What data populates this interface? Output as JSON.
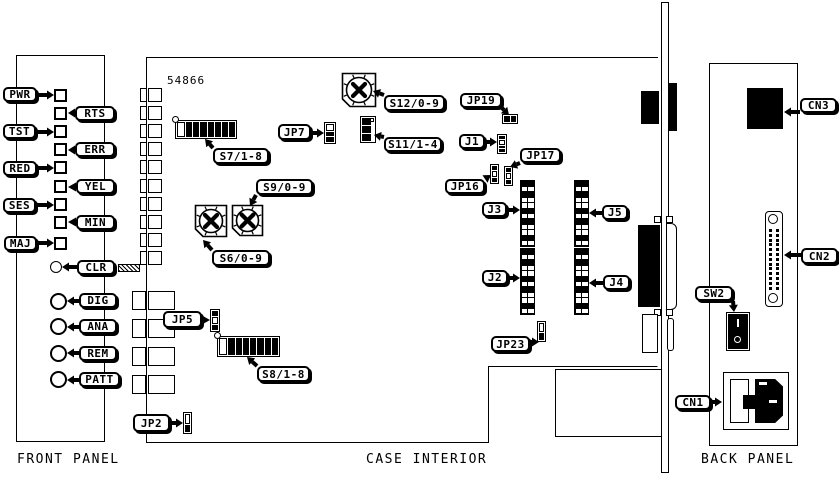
{
  "front_panel": {
    "caption": "FRONT PANEL"
  },
  "case_interior": {
    "caption": "CASE INTERIOR",
    "board_number": "54866"
  },
  "back_panel": {
    "caption": "BACK PANEL",
    "switch_marks": [
      "I",
      "O"
    ]
  },
  "colors": {
    "line": "#000000",
    "background": "#ffffff"
  },
  "callouts": [
    {
      "text": "PWR",
      "x": 3,
      "y": 87,
      "w": 34,
      "h": 15,
      "tx": 54,
      "ty": 95
    },
    {
      "text": "RTS",
      "x": 75,
      "y": 106,
      "w": 40,
      "h": 15,
      "tx": 68,
      "ty": 113
    },
    {
      "text": "TST",
      "x": 3,
      "y": 124,
      "w": 33,
      "h": 15,
      "tx": 54,
      "ty": 132
    },
    {
      "text": "ERR",
      "x": 75,
      "y": 142,
      "w": 40,
      "h": 15,
      "tx": 68,
      "ty": 150
    },
    {
      "text": "RED",
      "x": 3,
      "y": 161,
      "w": 34,
      "h": 15,
      "tx": 54,
      "ty": 168
    },
    {
      "text": "YEL",
      "x": 76,
      "y": 179,
      "w": 39,
      "h": 15,
      "tx": 68,
      "ty": 187
    },
    {
      "text": "SES",
      "x": 3,
      "y": 198,
      "w": 33,
      "h": 15,
      "tx": 54,
      "ty": 205
    },
    {
      "text": "MIN",
      "x": 76,
      "y": 215,
      "w": 39,
      "h": 15,
      "tx": 68,
      "ty": 222
    },
    {
      "text": "MAJ",
      "x": 4,
      "y": 236,
      "w": 33,
      "h": 15,
      "tx": 54,
      "ty": 243
    },
    {
      "text": "CLR",
      "x": 77,
      "y": 260,
      "w": 38,
      "h": 15,
      "tx": 62,
      "ty": 267
    },
    {
      "text": "DIG",
      "x": 79,
      "y": 293,
      "w": 38,
      "h": 15,
      "tx": 67,
      "ty": 301
    },
    {
      "text": "ANA",
      "x": 79,
      "y": 319,
      "w": 38,
      "h": 15,
      "tx": 67,
      "ty": 327
    },
    {
      "text": "REM",
      "x": 79,
      "y": 346,
      "w": 38,
      "h": 15,
      "tx": 67,
      "ty": 353
    },
    {
      "text": "PATT",
      "x": 79,
      "y": 372,
      "w": 41,
      "h": 15,
      "tx": 67,
      "ty": 380
    },
    {
      "text": "S7/1-8",
      "x": 213,
      "y": 148,
      "w": 56,
      "h": 16,
      "tx": 205,
      "ty": 139
    },
    {
      "text": "JP7",
      "x": 278,
      "y": 124,
      "w": 33,
      "h": 16,
      "tx": 324,
      "ty": 133
    },
    {
      "text": "S12/0-9",
      "x": 384,
      "y": 95,
      "w": 61,
      "h": 16,
      "tx": 373,
      "ty": 91
    },
    {
      "text": "JP19",
      "x": 460,
      "y": 93,
      "w": 42,
      "h": 15,
      "tx": 509,
      "ty": 115
    },
    {
      "text": "S11/1-4",
      "x": 384,
      "y": 137,
      "w": 58,
      "h": 15,
      "tx": 374,
      "ty": 135
    },
    {
      "text": "J1",
      "x": 459,
      "y": 134,
      "w": 26,
      "h": 15,
      "tx": 497,
      "ty": 142
    },
    {
      "text": "JP16",
      "x": 445,
      "y": 179,
      "w": 40,
      "h": 15,
      "tx": 491,
      "ty": 175
    },
    {
      "text": "JP17",
      "x": 520,
      "y": 148,
      "w": 41,
      "h": 15,
      "tx": 510,
      "ty": 167
    },
    {
      "text": "S9/0-9",
      "x": 256,
      "y": 179,
      "w": 57,
      "h": 16,
      "tx": 250,
      "ty": 206
    },
    {
      "text": "S6/0-9",
      "x": 212,
      "y": 250,
      "w": 58,
      "h": 16,
      "tx": 203,
      "ty": 240
    },
    {
      "text": "J3",
      "x": 482,
      "y": 202,
      "w": 25,
      "h": 15,
      "tx": 520,
      "ty": 210
    },
    {
      "text": "J2",
      "x": 482,
      "y": 270,
      "w": 26,
      "h": 15,
      "tx": 520,
      "ty": 278
    },
    {
      "text": "J5",
      "x": 602,
      "y": 205,
      "w": 26,
      "h": 15,
      "tx": 589,
      "ty": 213
    },
    {
      "text": "J4",
      "x": 603,
      "y": 275,
      "w": 27,
      "h": 15,
      "tx": 589,
      "ty": 283
    },
    {
      "text": "JP5",
      "x": 163,
      "y": 311,
      "w": 39,
      "h": 17,
      "tx": 210,
      "ty": 320
    },
    {
      "text": "S8/1-8",
      "x": 257,
      "y": 366,
      "w": 53,
      "h": 16,
      "tx": 247,
      "ty": 357
    },
    {
      "text": "JP23",
      "x": 491,
      "y": 336,
      "w": 39,
      "h": 16,
      "tx": 539,
      "ty": 342
    },
    {
      "text": "JP2",
      "x": 133,
      "y": 414,
      "w": 37,
      "h": 18,
      "tx": 183,
      "ty": 423
    },
    {
      "text": "CN3",
      "x": 800,
      "y": 98,
      "w": 37,
      "h": 15,
      "tx": 784,
      "ty": 112
    },
    {
      "text": "CN2",
      "x": 801,
      "y": 248,
      "w": 37,
      "h": 16,
      "tx": 784,
      "ty": 255
    },
    {
      "text": "SW2",
      "x": 695,
      "y": 286,
      "w": 38,
      "h": 15,
      "tx": 734,
      "ty": 312
    },
    {
      "text": "CN1",
      "x": 675,
      "y": 395,
      "w": 36,
      "h": 15,
      "tx": 722,
      "ty": 402
    }
  ],
  "components": [
    {
      "id": "led-pwr",
      "type": "led",
      "x": 54,
      "y": 89
    },
    {
      "id": "led-rts",
      "type": "led",
      "x": 54,
      "y": 107
    },
    {
      "id": "led-tst",
      "type": "led",
      "x": 54,
      "y": 125
    },
    {
      "id": "led-err",
      "type": "led",
      "x": 54,
      "y": 143
    },
    {
      "id": "led-red",
      "type": "led",
      "x": 54,
      "y": 161
    },
    {
      "id": "led-yel",
      "type": "led",
      "x": 54,
      "y": 180
    },
    {
      "id": "led-ses",
      "type": "led",
      "x": 54,
      "y": 198
    },
    {
      "id": "led-min",
      "type": "led",
      "x": 54,
      "y": 216
    },
    {
      "id": "led-maj",
      "type": "led",
      "x": 54,
      "y": 237
    },
    {
      "id": "clr-button",
      "type": "circle",
      "x": 50,
      "y": 261,
      "d": 12
    },
    {
      "id": "dig-button",
      "type": "circle",
      "x": 50,
      "y": 293,
      "d": 17
    },
    {
      "id": "ana-button",
      "type": "circle",
      "x": 50,
      "y": 318,
      "d": 17
    },
    {
      "id": "rem-button",
      "type": "circle",
      "x": 50,
      "y": 345,
      "d": 17
    },
    {
      "id": "patt-button",
      "type": "circle",
      "x": 50,
      "y": 371,
      "d": 17
    },
    {
      "id": "edge-connectors-small",
      "type": "edge-rows",
      "x1": 140,
      "w1": 7,
      "x2": 148,
      "w2": 14,
      "h": 14,
      "ys": [
        88,
        106,
        124,
        142,
        160,
        179,
        197,
        215,
        233,
        251
      ]
    },
    {
      "id": "edge-connectors-large",
      "type": "edge-rows",
      "x1": 132,
      "w1": 14,
      "x2": 148,
      "w2": 27,
      "h": 19,
      "ys": [
        291,
        319,
        347,
        375
      ]
    },
    {
      "id": "ribbon-hatch",
      "type": "hatch",
      "x": 118,
      "y": 264,
      "w": 22,
      "h": 8
    },
    {
      "id": "dip-s7",
      "type": "dip",
      "x": 175,
      "y": 120,
      "w": 62,
      "h": 19,
      "cells": [
        "w",
        "b",
        "b",
        "b",
        "b",
        "b",
        "b",
        "b"
      ]
    },
    {
      "id": "dip-s8",
      "type": "dip",
      "x": 217,
      "y": 336,
      "w": 63,
      "h": 21,
      "cells": [
        "w",
        "b",
        "b",
        "b",
        "b",
        "b",
        "b",
        "b"
      ]
    },
    {
      "id": "dip-s11",
      "type": "dipv",
      "x": 360,
      "y": 116,
      "w": 16,
      "h": 27
    },
    {
      "id": "rotary-s12",
      "type": "rotary",
      "x": 341,
      "y": 72,
      "s": 36
    },
    {
      "id": "rotary-s9",
      "type": "rotary",
      "x": 231,
      "y": 204,
      "s": 33
    },
    {
      "id": "rotary-s6",
      "type": "rotary",
      "x": 194,
      "y": 204,
      "s": 34
    },
    {
      "id": "jumper-jp7",
      "type": "jumper",
      "x": 324,
      "y": 122,
      "w": 12,
      "h": 22,
      "dir": "v",
      "cells": [
        "w",
        "b",
        "b"
      ]
    },
    {
      "id": "jumper-jp19",
      "type": "jumper",
      "x": 502,
      "y": 114,
      "w": 16,
      "h": 10,
      "dir": "h",
      "cells": [
        "b",
        "b"
      ]
    },
    {
      "id": "conn-j1",
      "type": "jumper",
      "x": 497,
      "y": 134,
      "w": 10,
      "h": 20,
      "dir": "v",
      "cells": [
        "b",
        "w",
        "b",
        "b"
      ]
    },
    {
      "id": "jumper-jp16",
      "type": "jumper",
      "x": 490,
      "y": 164,
      "w": 9,
      "h": 20,
      "dir": "v",
      "cells": [
        "b",
        "w",
        "b"
      ]
    },
    {
      "id": "jumper-jp17",
      "type": "jumper",
      "x": 504,
      "y": 166,
      "w": 9,
      "h": 20,
      "dir": "v",
      "cells": [
        "b",
        "w",
        "b"
      ]
    },
    {
      "id": "jumper-jp23",
      "type": "jumper",
      "x": 537,
      "y": 321,
      "w": 9,
      "h": 21,
      "dir": "v",
      "cells": [
        "w",
        "b"
      ]
    },
    {
      "id": "jumper-jp5",
      "type": "jumper",
      "x": 210,
      "y": 309,
      "w": 10,
      "h": 23,
      "dir": "v",
      "cells": [
        "b",
        "w",
        "b"
      ]
    },
    {
      "id": "jumper-jp2",
      "type": "jumper",
      "x": 183,
      "y": 412,
      "w": 9,
      "h": 22,
      "dir": "v",
      "cells": [
        "w",
        "b"
      ]
    },
    {
      "id": "conn-j3",
      "type": "grid",
      "x": 520,
      "y": 180,
      "w": 15,
      "h": 67,
      "rows": 12
    },
    {
      "id": "conn-j2",
      "type": "grid",
      "x": 520,
      "y": 248,
      "w": 15,
      "h": 67,
      "rows": 12
    },
    {
      "id": "conn-j5",
      "type": "grid",
      "x": 574,
      "y": 180,
      "w": 15,
      "h": 67,
      "rows": 12
    },
    {
      "id": "conn-j4",
      "type": "grid",
      "x": 574,
      "y": 248,
      "w": 15,
      "h": 67,
      "rows": 12
    },
    {
      "id": "cn3-board-connector",
      "type": "rect",
      "x": 641,
      "y": 91,
      "w": 18,
      "h": 33,
      "fill": "black"
    },
    {
      "id": "cn3-bracket-connector",
      "type": "rect",
      "x": 668,
      "y": 83,
      "w": 9,
      "h": 48,
      "fill": "black"
    },
    {
      "id": "cn2-board-connector",
      "type": "rect",
      "x": 638,
      "y": 225,
      "w": 22,
      "h": 82,
      "fill": "black"
    },
    {
      "id": "cn2-bracket-shell",
      "type": "rect",
      "x": 666,
      "y": 223,
      "w": 11,
      "h": 87,
      "stroke": true,
      "radius": "0 6px 6px 0"
    },
    {
      "id": "cn2-mount-screw",
      "type": "rect",
      "x": 654,
      "y": 216,
      "w": 7,
      "h": 7,
      "stroke": true
    },
    {
      "id": "cn2-mount-screw",
      "type": "rect",
      "x": 666,
      "y": 216,
      "w": 7,
      "h": 7,
      "stroke": true
    },
    {
      "id": "cn2-mount-screw",
      "type": "rect",
      "x": 654,
      "y": 309,
      "w": 7,
      "h": 7,
      "stroke": true
    },
    {
      "id": "cn2-mount-screw",
      "type": "rect",
      "x": 666,
      "y": 309,
      "w": 7,
      "h": 7,
      "stroke": true
    },
    {
      "id": "cable-clamp",
      "type": "rect",
      "x": 667,
      "y": 318,
      "w": 7,
      "h": 33,
      "stroke": true,
      "radius": "3px"
    },
    {
      "id": "component-box",
      "type": "rect",
      "x": 642,
      "y": 314,
      "w": 16,
      "h": 39,
      "stroke": true
    },
    {
      "id": "cn3-back-connector",
      "type": "rect",
      "x": 747,
      "y": 88,
      "w": 36,
      "h": 41,
      "fill": "black"
    },
    {
      "id": "cn2-back-dsub",
      "type": "dsub",
      "x": 765,
      "y": 211,
      "w": 18,
      "h": 96
    },
    {
      "id": "sw2-power-switch",
      "type": "switch",
      "x": 726,
      "y": 312,
      "w": 24,
      "h": 39,
      "marks": [
        "I",
        "O"
      ]
    },
    {
      "id": "cn1-power-inlet",
      "type": "inlet",
      "x": 723,
      "y": 372,
      "w": 66,
      "h": 58
    }
  ]
}
